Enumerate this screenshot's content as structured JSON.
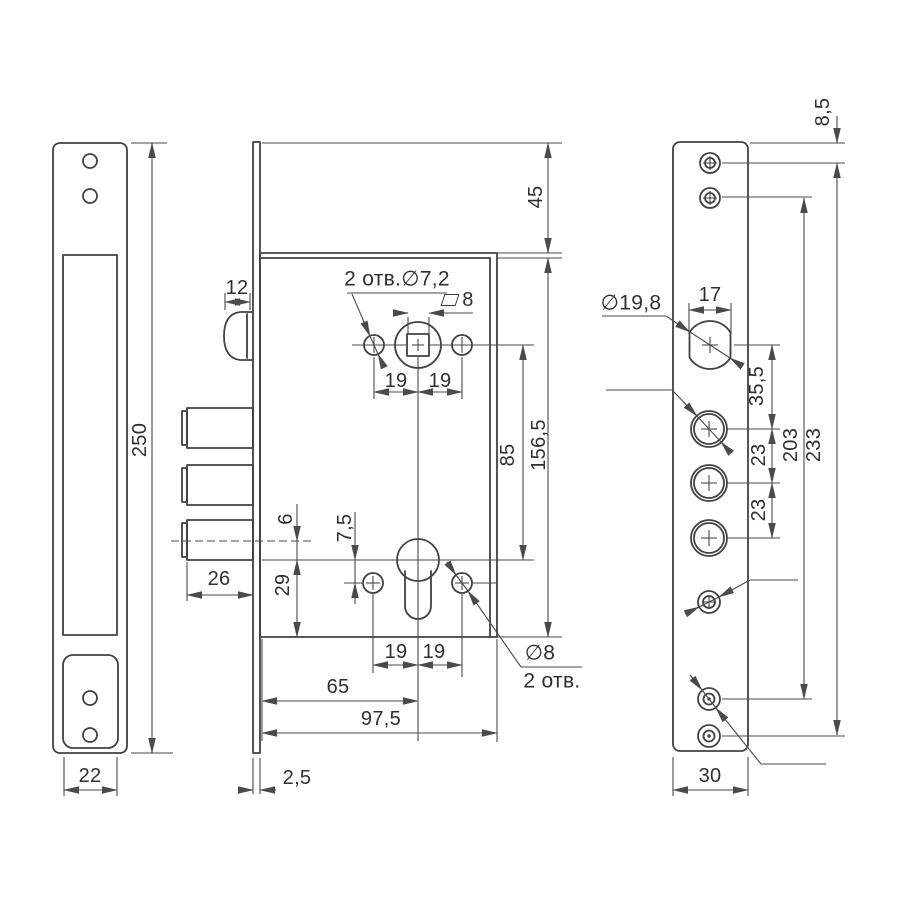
{
  "drawing_type": "mortise lock technical drawing, three orthographic views",
  "colors": {
    "background": "#ffffff",
    "line": "#414141",
    "dimension_line": "#4a4a4a",
    "text": "#2f2f2f"
  },
  "front": {
    "height": "250",
    "width": "22"
  },
  "body": {
    "latch_width": "12",
    "holes_note_top": "2 отв.∅7,2",
    "square_size": "8",
    "pitch_top_left": "19",
    "pitch_top_right": "19",
    "top_margin": "45",
    "bolt_throw": "26",
    "axis_gap": "6",
    "aux_hole_gap": "7,5",
    "cyl_to_bottom": "29",
    "follower_to_cyl": "85",
    "case_height": "156,5",
    "pitch_bottom_left": "19",
    "pitch_bottom_right": "19",
    "backset": "65",
    "case_depth": "97,5",
    "forend_thickness": "2,5",
    "holes_note_bottom_d": "∅8",
    "holes_note_bottom_n": "2 отв."
  },
  "plate": {
    "top_offset": "8,5",
    "spindle_hole_d": "∅19,8",
    "spindle_hole_w": "17",
    "bolt_hole_d": "∅15,8",
    "spindle_to_bolt": "35,5",
    "bolt_pitch_a": "23",
    "bolt_pitch_b": "23",
    "screw_span_inner": "203",
    "screw_span_outer": "233",
    "pin_hole_d": "∅5,2",
    "screw_hole_d": "∅4,5",
    "screw_hole_n": "4 отв.",
    "width": "30"
  }
}
